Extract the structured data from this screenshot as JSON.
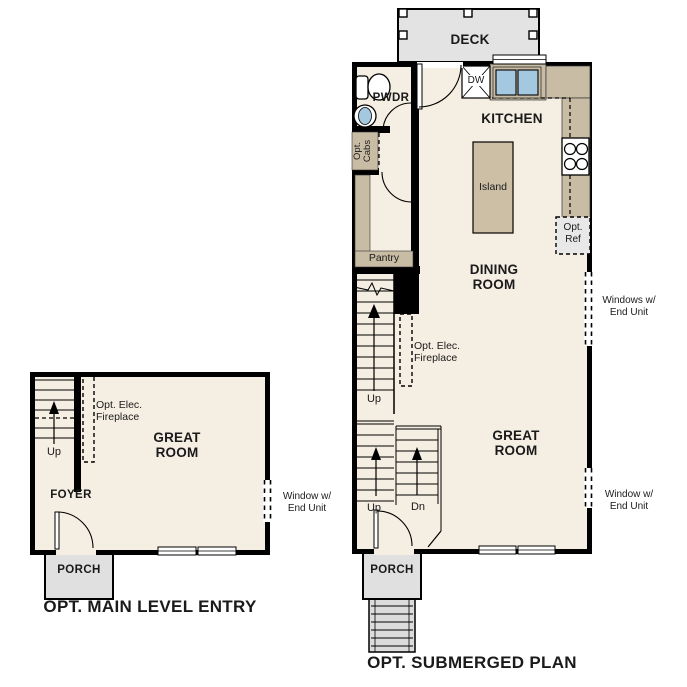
{
  "colors": {
    "floor": "#F5EEE2",
    "wall": "#000000",
    "counter": "#C9BCA4",
    "island": "#CCBFA6",
    "deck": "#E3E3E3",
    "porch": "#E0E0E0",
    "steps": "#DCDCDC",
    "sink_blue": "#A5C8E1",
    "ref_gray": "#E8E8E8"
  },
  "left_plan": {
    "title": "OPT. MAIN LEVEL ENTRY",
    "labels": {
      "great_room": "GREAT ROOM",
      "foyer": "FOYER",
      "porch": "PORCH",
      "up": "Up",
      "fireplace": "Opt. Elec. Fireplace",
      "window": "Window w/ End Unit"
    }
  },
  "right_plan": {
    "title": "OPT. SUBMERGED PLAN",
    "labels": {
      "deck": "DECK",
      "pwdr": "PWDR",
      "kitchen": "KITCHEN",
      "island": "Island",
      "dining_room": "DINING ROOM",
      "great_room": "GREAT ROOM",
      "porch": "PORCH",
      "pantry": "Pantry",
      "dw": "DW",
      "opt_cabs": "Opt. Cabs",
      "opt_ref": "Opt. Ref",
      "fireplace": "Opt. Elec. Fireplace",
      "windows": "Windows w/ End Unit",
      "window": "Window w/ End Unit",
      "up_main": "Up",
      "up_lower": "Up",
      "dn": "Dn"
    }
  }
}
